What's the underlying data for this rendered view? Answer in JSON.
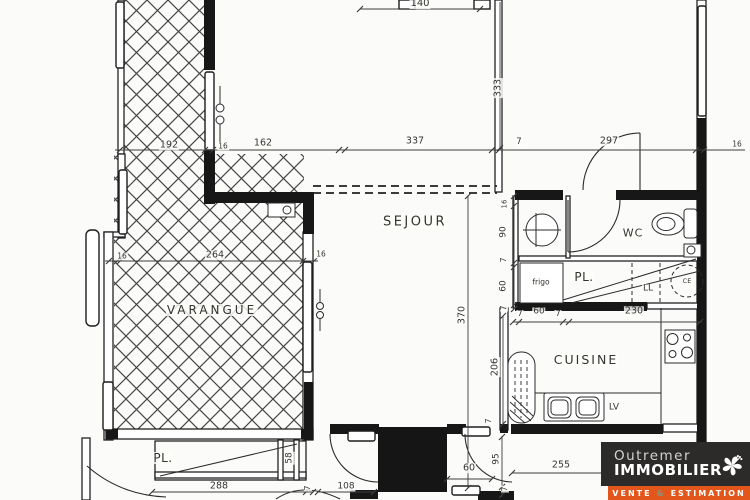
{
  "plan": {
    "room_labels": [
      {
        "name": "room-label-sejour",
        "text": "SEJOUR",
        "x": 415,
        "y": 222,
        "size": 13,
        "ls": 2.5
      },
      {
        "name": "room-label-varangue",
        "text": "VARANGUE",
        "x": 212,
        "y": 310,
        "size": 12,
        "ls": 3
      },
      {
        "name": "room-label-wc",
        "text": "WC",
        "x": 633,
        "y": 233,
        "size": 11,
        "ls": 1
      },
      {
        "name": "room-label-cuisine",
        "text": "CUISINE",
        "x": 586,
        "y": 360,
        "size": 12.5,
        "ls": 2
      },
      {
        "name": "room-label-placard-upper",
        "text": "PL.",
        "x": 584,
        "y": 277,
        "size": 12,
        "ls": 0.5
      },
      {
        "name": "room-label-placard-lower",
        "text": "PL.",
        "x": 163,
        "y": 458,
        "size": 12,
        "ls": 0.5
      },
      {
        "name": "fixture-label-frigo",
        "text": "frigo",
        "x": 541,
        "y": 282,
        "size": 7.5
      },
      {
        "name": "fixture-label-lave-linge",
        "text": "LL",
        "x": 648,
        "y": 289,
        "size": 9
      },
      {
        "name": "fixture-label-chauffe-eau",
        "text": "CE",
        "x": 687,
        "y": 281,
        "size": 6.5
      },
      {
        "name": "fixture-label-lave-vaisselle",
        "text": "LV",
        "x": 614,
        "y": 408,
        "size": 9
      },
      {
        "name": "dim-label-58",
        "text": "58",
        "x": 290,
        "y": 458,
        "size": 9,
        "rot": -90
      }
    ],
    "dim_labels": [
      {
        "text": "140",
        "x": 420,
        "y": 4,
        "size": 10
      },
      {
        "text": "192",
        "x": 169,
        "y": 145,
        "size": 9.5
      },
      {
        "text": "16",
        "x": 223,
        "y": 146,
        "size": 7.5
      },
      {
        "text": "162",
        "x": 263,
        "y": 143,
        "size": 9.5
      },
      {
        "text": "337",
        "x": 415,
        "y": 141,
        "size": 9.5
      },
      {
        "text": "7",
        "x": 519,
        "y": 142,
        "size": 8.5
      },
      {
        "text": "297",
        "x": 609,
        "y": 141,
        "size": 9.5
      },
      {
        "text": "16",
        "x": 737,
        "y": 144,
        "size": 7.5
      },
      {
        "text": "333",
        "x": 498,
        "y": 88,
        "size": 9.5,
        "rot": -90
      },
      {
        "text": "370",
        "x": 462,
        "y": 315,
        "size": 9.5,
        "rot": -90
      },
      {
        "text": "16",
        "x": 505,
        "y": 204,
        "size": 7,
        "rot": -90
      },
      {
        "text": "90",
        "x": 504,
        "y": 232,
        "size": 9,
        "rot": -90
      },
      {
        "text": "7",
        "x": 504,
        "y": 260,
        "size": 8,
        "rot": -90
      },
      {
        "text": "60",
        "x": 504,
        "y": 286,
        "size": 9,
        "rot": -90
      },
      {
        "text": "7",
        "x": 504,
        "y": 308,
        "size": 8,
        "rot": -90
      },
      {
        "text": "206",
        "x": 495,
        "y": 367,
        "size": 9.5,
        "rot": -90
      },
      {
        "text": "16",
        "x": 122,
        "y": 256,
        "size": 7.5
      },
      {
        "text": "264",
        "x": 215,
        "y": 255,
        "size": 9.5
      },
      {
        "text": "16",
        "x": 321,
        "y": 254,
        "size": 7.5
      },
      {
        "text": "7",
        "x": 520,
        "y": 314,
        "size": 8
      },
      {
        "text": "60",
        "x": 539,
        "y": 312,
        "size": 9
      },
      {
        "text": "7",
        "x": 558,
        "y": 314,
        "size": 8
      },
      {
        "text": "230",
        "x": 634,
        "y": 311,
        "size": 9.5
      },
      {
        "text": "288",
        "x": 219,
        "y": 486,
        "size": 9.5
      },
      {
        "text": "7",
        "x": 308,
        "y": 488,
        "size": 8,
        "rot": -90
      },
      {
        "text": "108",
        "x": 346,
        "y": 487,
        "size": 9
      },
      {
        "text": "60",
        "x": 469,
        "y": 468,
        "size": 9.5
      },
      {
        "text": "95",
        "x": 497,
        "y": 459,
        "size": 9,
        "rot": -90
      },
      {
        "text": "7",
        "x": 505,
        "y": 489,
        "size": 8,
        "rot": -90
      },
      {
        "text": "255",
        "x": 561,
        "y": 465,
        "size": 9.5
      },
      {
        "text": "7",
        "x": 489,
        "y": 421,
        "size": 8,
        "rot": -90
      }
    ]
  },
  "logo": {
    "brand_line1": "Outremer",
    "brand_line2": "IMMOBILIER",
    "tagline_word1": "VENTE",
    "tagline_amp": "&",
    "tagline_word2": "ESTIMATION",
    "colors": {
      "panel": "#2d2b2a",
      "banner": "#e2561c",
      "brand_line1": "#d6d4d2",
      "brand_line2": "#ffffff",
      "tagline": "#ffffff",
      "amp": "#8f8f78",
      "flower": "#ffffff"
    }
  }
}
